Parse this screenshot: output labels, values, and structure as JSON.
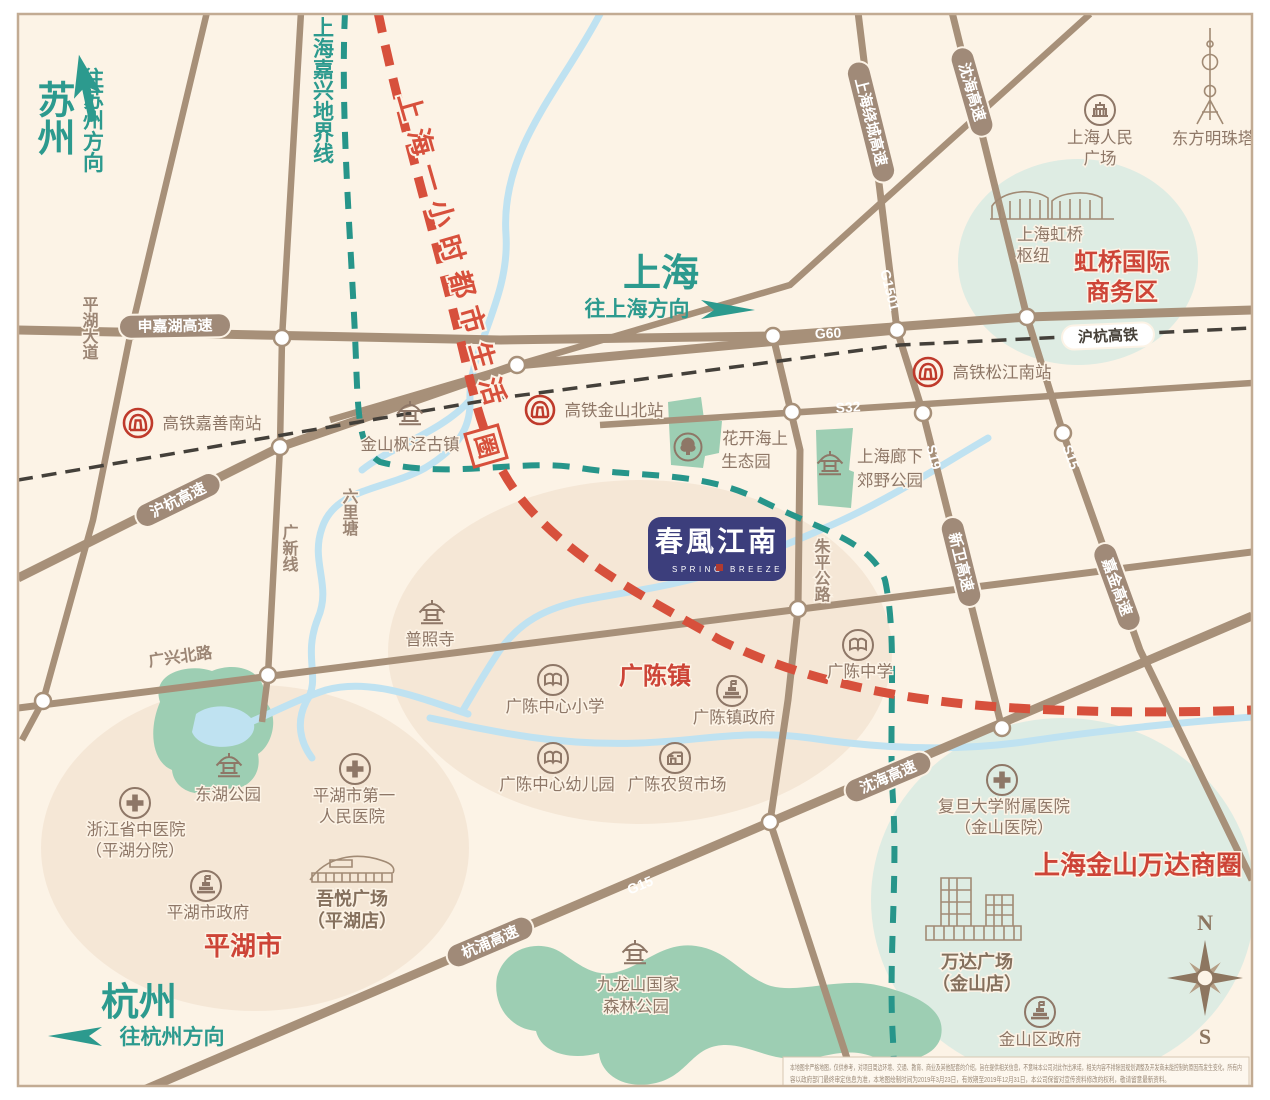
{
  "colors": {
    "background": "#fcf3e6",
    "road_brown": "#a79079",
    "teal": "#2c9a8e",
    "red": "#d7503c",
    "label_brown": "#8e7767",
    "river_blue": "#bfe2f1",
    "park_green": "#9dceb3",
    "logo_navy": "#3c3e7c",
    "rail_black": "#44403a"
  },
  "cities": {
    "suzhou": "苏州",
    "suzhou_dir": "往苏州方向",
    "shanghai": "上海",
    "shanghai_dir": "往上海方向",
    "hangzhou": "杭州",
    "hangzhou_dir": "往杭州方向"
  },
  "lines": {
    "boundary": "上海嘉兴地界线",
    "life_circle": "上海一小时都市生活",
    "life_circle_end": "圈",
    "rail": "沪杭高铁"
  },
  "roads": {
    "shenjiahu": "申嘉湖高速",
    "g60": "G60",
    "huhang_expwy": "沪杭高速",
    "raocheng": "上海绕城高速",
    "g1501": "G1501",
    "shenhai_n": "沈海高速",
    "s32": "S32",
    "s19": "S19",
    "s15": "S15",
    "xinwei": "新卫高速",
    "jiajin": "嘉金高速",
    "shenhai_s": "沈海高速",
    "g15": "G15",
    "hangpu": "杭浦高速",
    "pinghu_ave": "平湖大道",
    "guangxin": "广新线",
    "guangxing": "广兴北路",
    "zhuping": "朱平公路",
    "liulitang": "六里塘"
  },
  "stations": {
    "jiashan_south": "高铁嘉善南站",
    "jinshan_north": "高铁金山北站",
    "songjiang_south": "高铁松江南站"
  },
  "places": {
    "fengjing": "金山枫泾古镇",
    "huakai_1": "花开海上",
    "huakai_2": "生态园",
    "langxia_1": "上海廊下",
    "langxia_2": "郊野公园",
    "renmin_1": "上海人民",
    "renmin_2": "广场",
    "pearl": "东方明珠塔",
    "hongqiao_hub_1": "上海虹桥",
    "hongqiao_hub_2": "枢纽",
    "puzhao": "普照寺",
    "gc_primary": "广陈中心小学",
    "gc_gov": "广陈镇政府",
    "gc_middle": "广陈中学",
    "gc_kinder": "广陈中心幼儿园",
    "gc_market": "广陈农贸市场",
    "donghu": "东湖公园",
    "zj_hosp_1": "浙江省中医院",
    "zj_hosp_2": "（平湖分院）",
    "ph_hosp_1": "平湖市第一",
    "ph_hosp_2": "人民医院",
    "ph_gov": "平湖市政府",
    "wuyue_1": "吾悦广场",
    "wuyue_2": "（平湖店）",
    "jiulong_1": "九龙山国家",
    "jiulong_2": "森林公园",
    "fudan_1": "复旦大学附属医院",
    "fudan_2": "（金山医院）",
    "wanda_1": "万达广场",
    "wanda_2": "（金山店）",
    "jinshan_gov": "金山区政府"
  },
  "zones": {
    "hongqiao_1": "虹桥国际",
    "hongqiao_2": "商务区",
    "guangchen": "广陈镇",
    "pinghu": "平湖市",
    "wanda": "上海金山万达商圈"
  },
  "logo": {
    "cn": "春風江南",
    "en1": "SPRING",
    "en2": "BREEZE"
  },
  "compass": {
    "n": "N",
    "s": "S"
  },
  "disclaimer": {
    "line1": "本地图非严格地图，仅供参考，对项目周边环境、交通、教育、商业及其他配套的介绍，旨在提供相关信息，不意味本公司对此作出承诺，相关内容不排除因规划调整及开发商未能控制的原因而发生变化，所有内",
    "line2": "容以政府部门最终审定信息为准，本地图绘制时间为2019年3月23日，有效期至2019年12月31日，本公司保留对宣传资料修改的权利，敬请留意最新资料。"
  }
}
